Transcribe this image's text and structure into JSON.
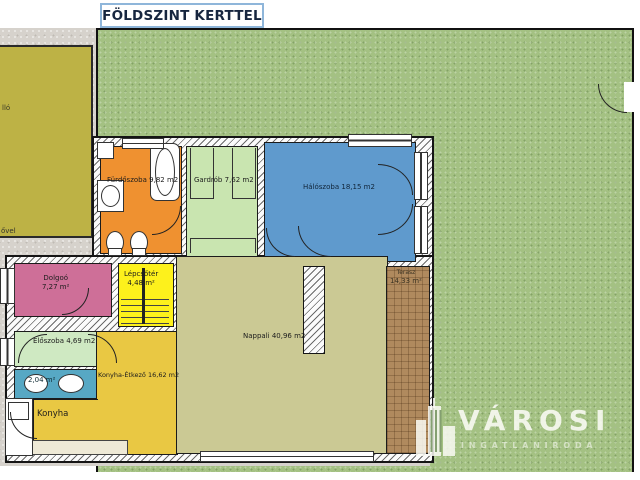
{
  "title": "FÖLDSZINT KERTTEL",
  "plan": {
    "rooms": {
      "carport_fragment": "lló",
      "paving_fragment": "ővel",
      "furdoszoba": {
        "name": "Fürdőszoba",
        "area": "9,82 m2"
      },
      "gardrob": {
        "name": "Gardrób",
        "area": "7,62 m2"
      },
      "haloszoba": {
        "name": "Hálószoba",
        "area": "18,15 m2"
      },
      "dolgozo": {
        "name": "Dolgoó",
        "area": "7,27 m²"
      },
      "lepcsoter": {
        "name": "Lépcsőtér",
        "area": "4,48 m²"
      },
      "eloszoba": {
        "name": "Előszoba",
        "area": "4,69 m2"
      },
      "wc": {
        "area": "2,04 m²"
      },
      "konyha_etkezo": {
        "name": "Konyha-Étkező",
        "area": "16,62 m2"
      },
      "konyha": {
        "name": "Konyha"
      },
      "nappali": {
        "name": "Nappali",
        "area": "40,96 m2"
      },
      "terasz": {
        "name": "Terasz",
        "area": "14,33 m²"
      }
    },
    "colors": {
      "grass": "#a4c183",
      "concrete": "#d6d2cc",
      "carport": "#bdb245",
      "furdoszoba": "#ef9130",
      "gardrob": "#c9e5b0",
      "haloszoba": "#5f9acd",
      "dolgozo": "#ce6f98",
      "lepcsoter": "#fdf11c",
      "eloszoba": "#cfe9c2",
      "wc": "#57a8c4",
      "konyha": "#e9c843",
      "nappali": "#cbc994",
      "terasz": "#b08a5e",
      "title_border": "#8fb6da"
    }
  },
  "logo": {
    "brand": "VÁROSI",
    "tagline": "INGATLANIRODA"
  }
}
